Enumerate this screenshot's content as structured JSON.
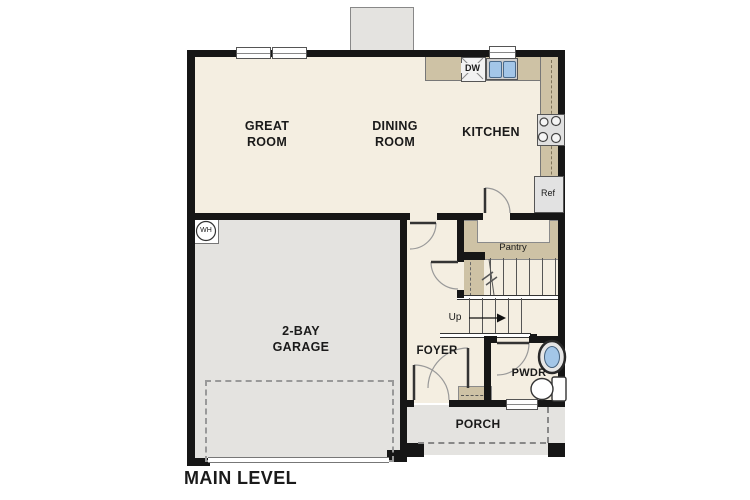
{
  "plan": {
    "title": "MAIN LEVEL",
    "rooms": {
      "great_room": "GREAT ROOM",
      "dining_room": "DINING ROOM",
      "kitchen": "KITCHEN",
      "garage": "2-BAY GARAGE",
      "foyer": "FOYER",
      "powder": "PWDR",
      "porch": "PORCH",
      "pantry": "Pantry"
    },
    "annotations": {
      "up": "Up",
      "ref": "Ref",
      "dw": "DW",
      "wh": "WH"
    },
    "colors": {
      "floor": "#f4eee1",
      "counter": "#cec2a5",
      "garage": "#e4e3e0",
      "wall": "#161616",
      "sink": "#a3c6e8"
    }
  }
}
